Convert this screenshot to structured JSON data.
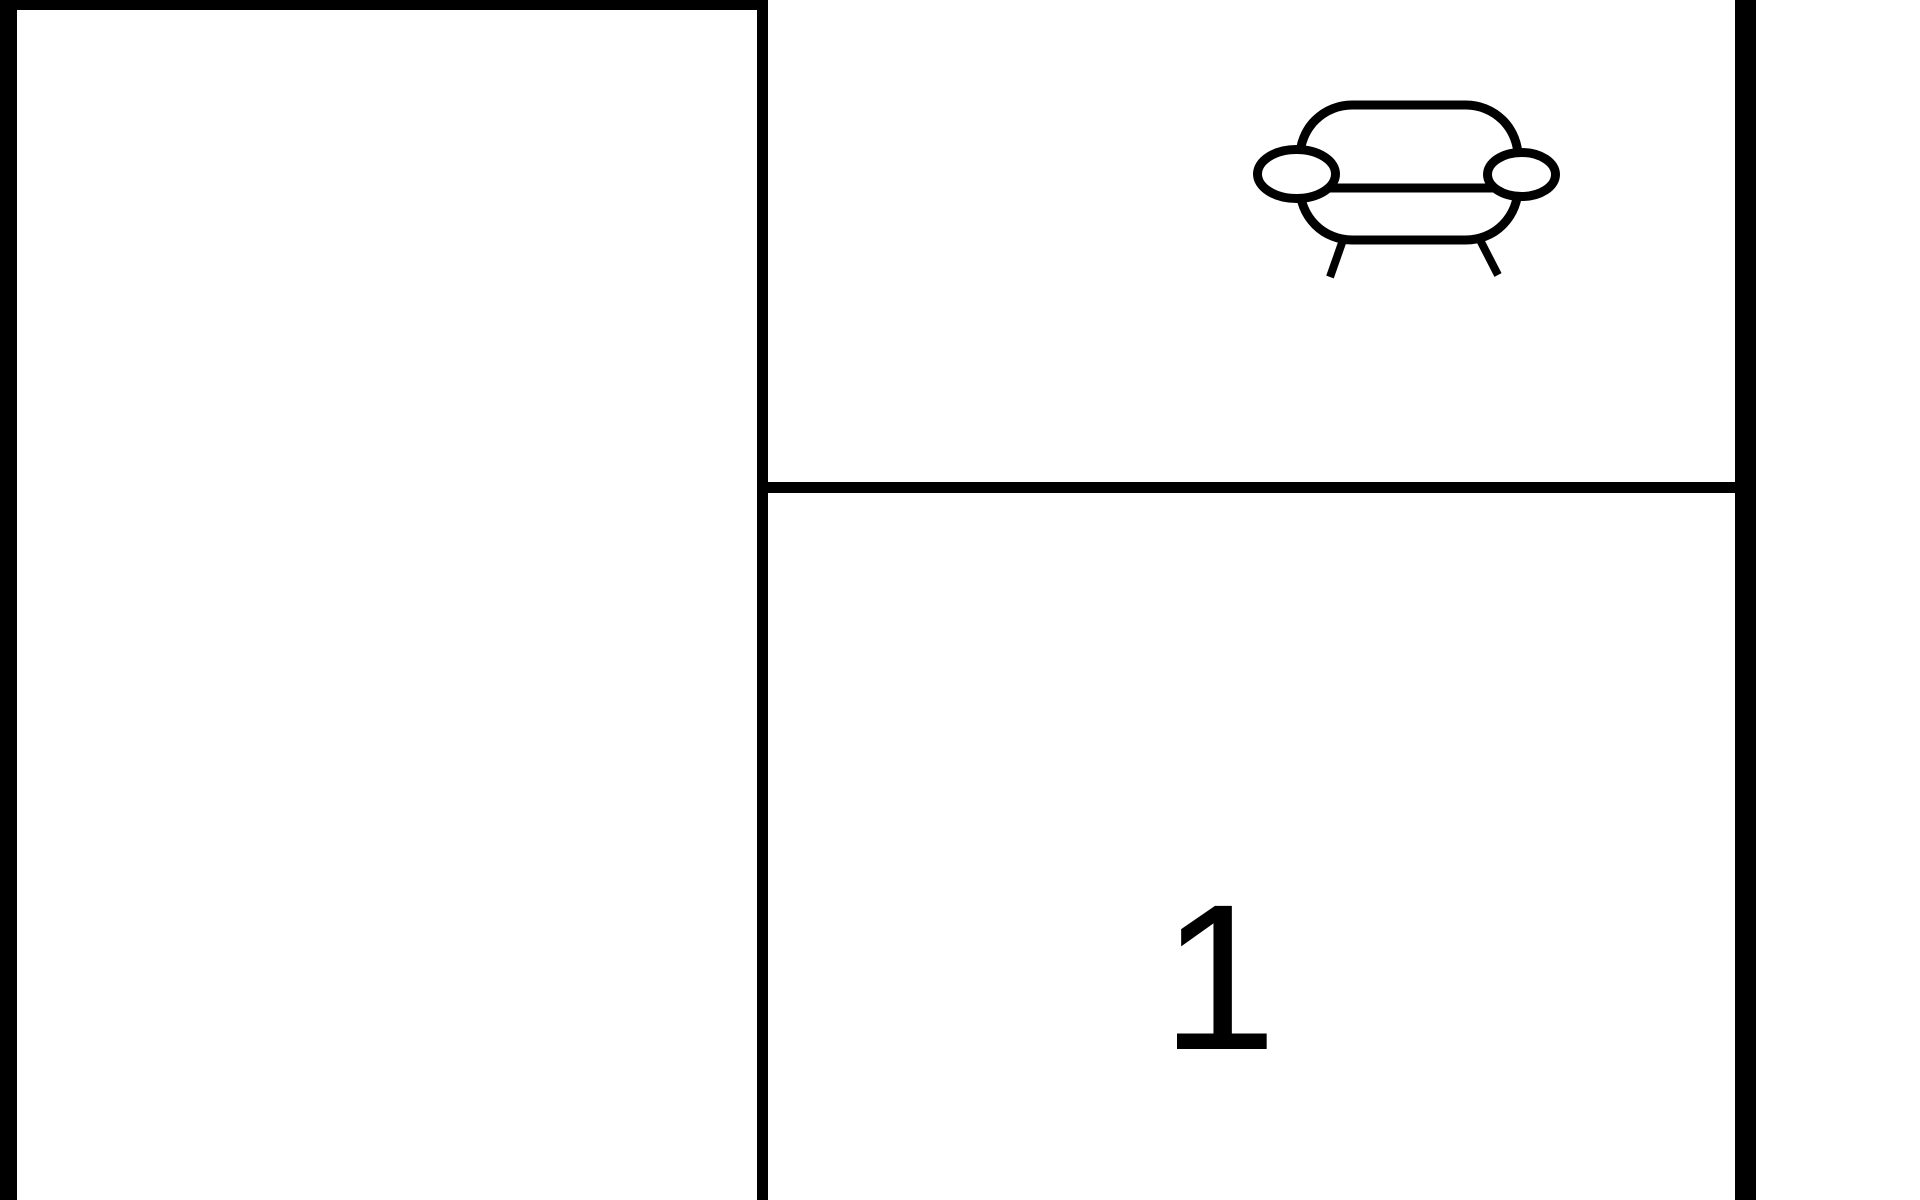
{
  "diagram": {
    "type": "floor-plan",
    "colors": {
      "background": "#ffffff",
      "line": "#000000"
    },
    "rooms": [
      {
        "name": "left-room",
        "label": ""
      },
      {
        "name": "top-right-room",
        "label": "",
        "icon": "sofa-icon"
      },
      {
        "name": "bottom-right-room",
        "label": "1"
      }
    ]
  }
}
